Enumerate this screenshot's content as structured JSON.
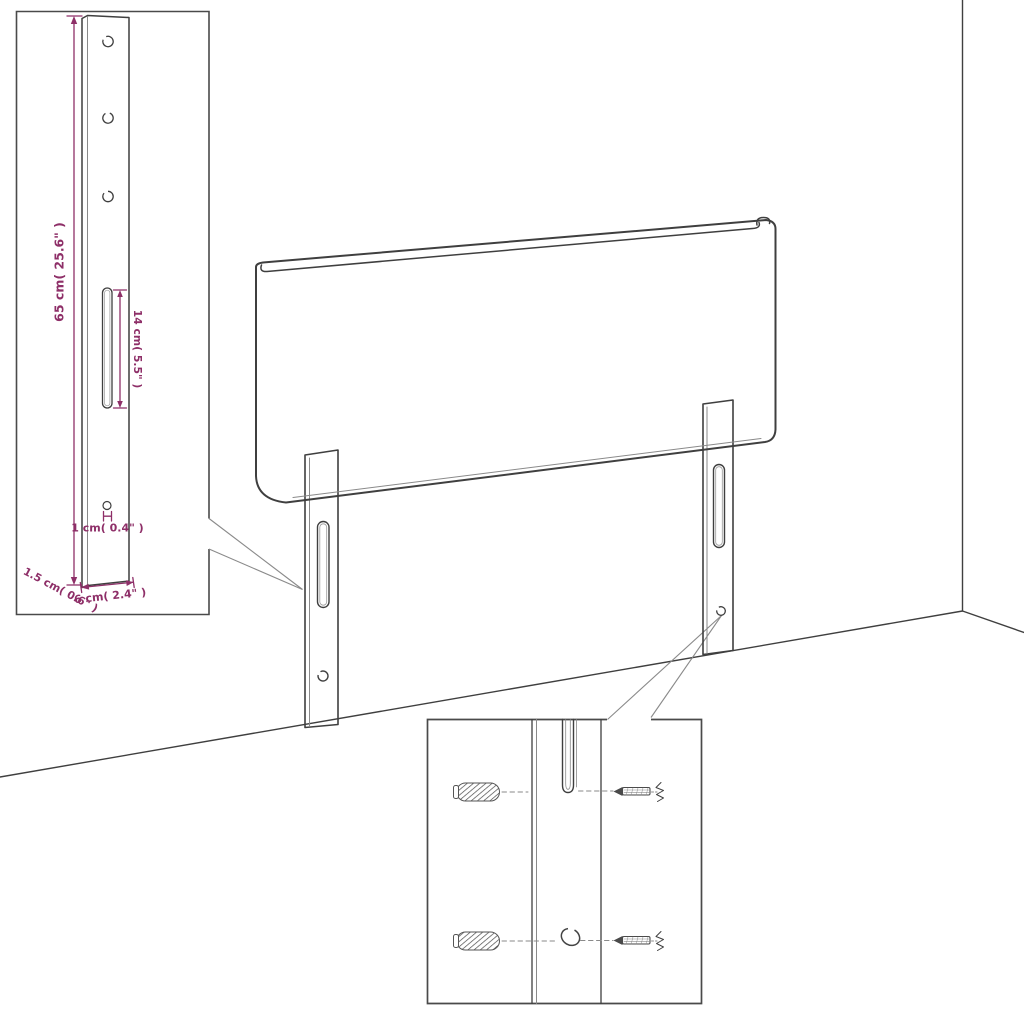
{
  "diagram": {
    "title": "headboard-assembly-dimension-diagram",
    "colors": {
      "dimension_accent": "#8e2f68",
      "line": "#3f3f3f",
      "background": "#ffffff"
    },
    "inset_bracket": {
      "dim_height": "65 cm( 25.6\" )",
      "dim_slot": "14 cm( 5.5\" )",
      "dim_hole": "1 cm( 0.4\" )",
      "dim_width": "6 cm( 2.4\" )",
      "dim_depth": "1.5 cm( 0.6\" )"
    }
  }
}
